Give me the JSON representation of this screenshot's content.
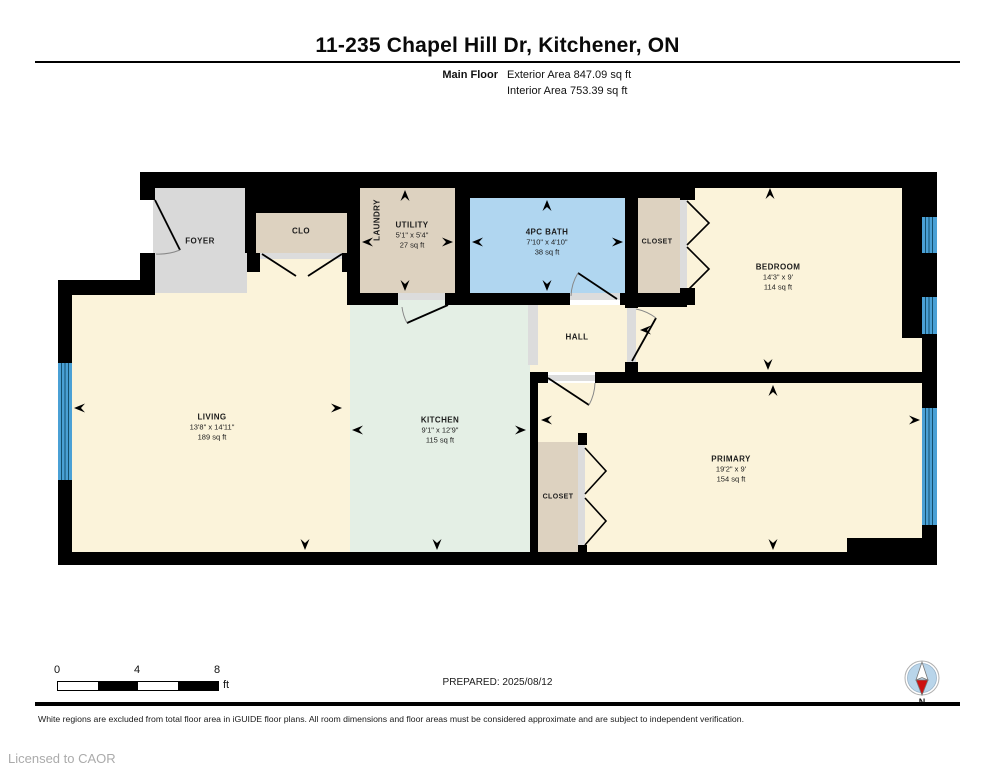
{
  "header": {
    "title": "11-235 Chapel Hill Dr, Kitchener, ON",
    "floor_label": "Main Floor",
    "exterior_area": "Exterior Area 847.09 sq ft",
    "interior_area": "Interior Area 753.39 sq ft"
  },
  "rooms": {
    "foyer": {
      "label": "FOYER"
    },
    "clo": {
      "label": "CLO"
    },
    "laundry": {
      "label": "LAUNDRY"
    },
    "utility": {
      "label": "UTILITY",
      "dims": "5'1\" x 5'4\"",
      "area": "27 sq ft"
    },
    "bath": {
      "label": "4PC BATH",
      "dims": "7'10\" x 4'10\"",
      "area": "38 sq ft"
    },
    "closet_top": {
      "label": "CLOSET"
    },
    "bedroom": {
      "label": "BEDROOM",
      "dims": "14'3\" x 9'",
      "area": "114 sq ft"
    },
    "hall": {
      "label": "HALL"
    },
    "living": {
      "label": "LIVING",
      "dims": "13'8\" x 14'11\"",
      "area": "189 sq ft"
    },
    "kitchen": {
      "label": "KITCHEN",
      "dims": "9'1\" x 12'9\"",
      "area": "115 sq ft"
    },
    "closet_bottom": {
      "label": "CLOSET"
    },
    "primary": {
      "label": "PRIMARY",
      "dims": "19'2\" x 9'",
      "area": "154 sq ft"
    }
  },
  "scale_bar": {
    "ticks": [
      "0",
      "4",
      "8"
    ],
    "unit": "ft"
  },
  "compass": {
    "label": "N"
  },
  "footer": {
    "prepared": "PREPARED: 2025/08/12",
    "disclaimer": "White regions are excluded from total floor area in iGUIDE floor plans. All room dimensions and floor areas must be considered approximate and are subject to independent verification.",
    "licensed": "Licensed to CAOR"
  },
  "colors": {
    "wall": "#000000",
    "room_cream": "#fbf3da",
    "room_mint": "#e4efe5",
    "room_beige": "#ddd2c0",
    "room_gray": "#d9d9d9",
    "bath_blue": "#b0d6f0",
    "window_blue": "#4aa0d5",
    "door_track_gray": "#dcdcdc",
    "compass_blue": "#b9d5ea",
    "compass_red": "#cc1111"
  }
}
